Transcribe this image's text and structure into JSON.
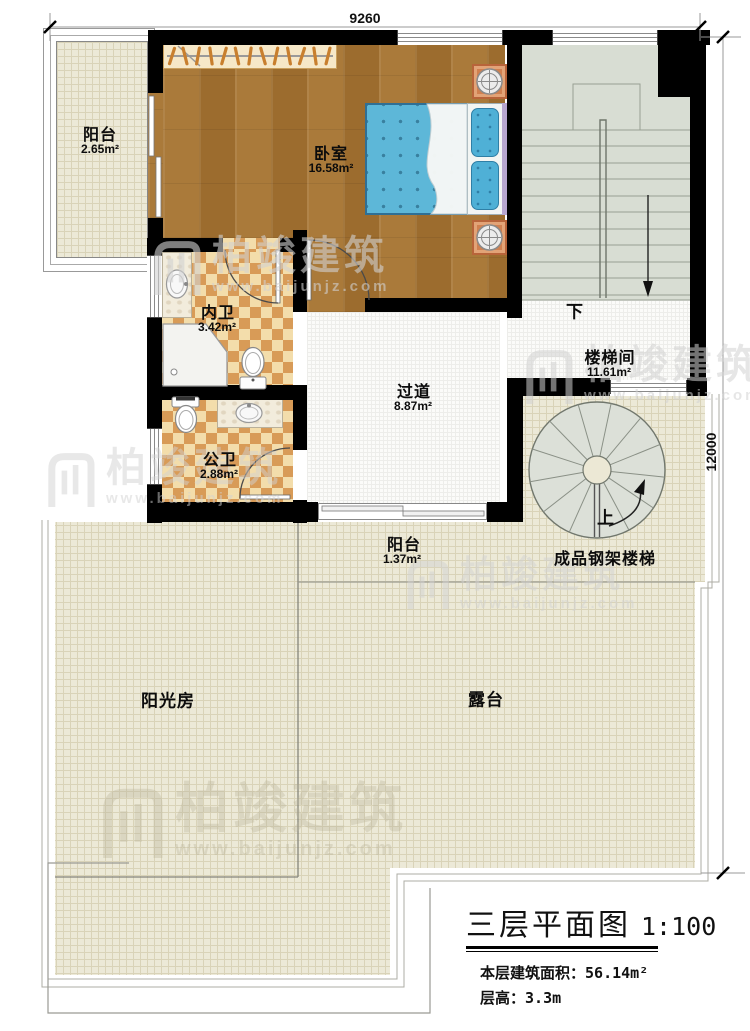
{
  "plan": {
    "dimensions": {
      "top": "9260",
      "right": "12000"
    },
    "rooms": {
      "balcony_top": {
        "name": "阳台",
        "area": "2.65m²"
      },
      "bedroom": {
        "name": "卧室",
        "area": "16.58m²"
      },
      "ensuite_bath": {
        "name": "内卫",
        "area": "3.42m²"
      },
      "public_bath": {
        "name": "公卫",
        "area": "2.88m²"
      },
      "corridor": {
        "name": "过道",
        "area": "8.87m²"
      },
      "stair_hall": {
        "name": "楼梯间",
        "area": "11.61m²"
      },
      "balcony_bottom": {
        "name": "阳台",
        "area": "1.37m²"
      },
      "sunroom": {
        "name": "阳光房"
      },
      "terrace": {
        "name": "露台"
      },
      "spiral_stair_label": "成品钢架楼梯",
      "stair_down_label": "下",
      "stair_up_label": "上"
    },
    "title_block": {
      "title": "三层平面图",
      "scale": "1:100",
      "floor_area_label": "本层建筑面积：",
      "floor_area_value": "56.14m²",
      "floor_height_label": "层高：",
      "floor_height_value": "3.3m"
    },
    "watermark": {
      "brand": "柏竣建筑",
      "url": "www.baijunjz.com"
    },
    "colors": {
      "wall": "#000000",
      "wood_floor": "#a37334",
      "bathroom_tile_light": "#f3ddab",
      "bathroom_tile_dark": "#d89b57",
      "outdoor_floor": "#ece9d7",
      "stair_floor": "#d8ddd3",
      "bed": "#5db7d8",
      "nightstand": "#d08050"
    }
  }
}
